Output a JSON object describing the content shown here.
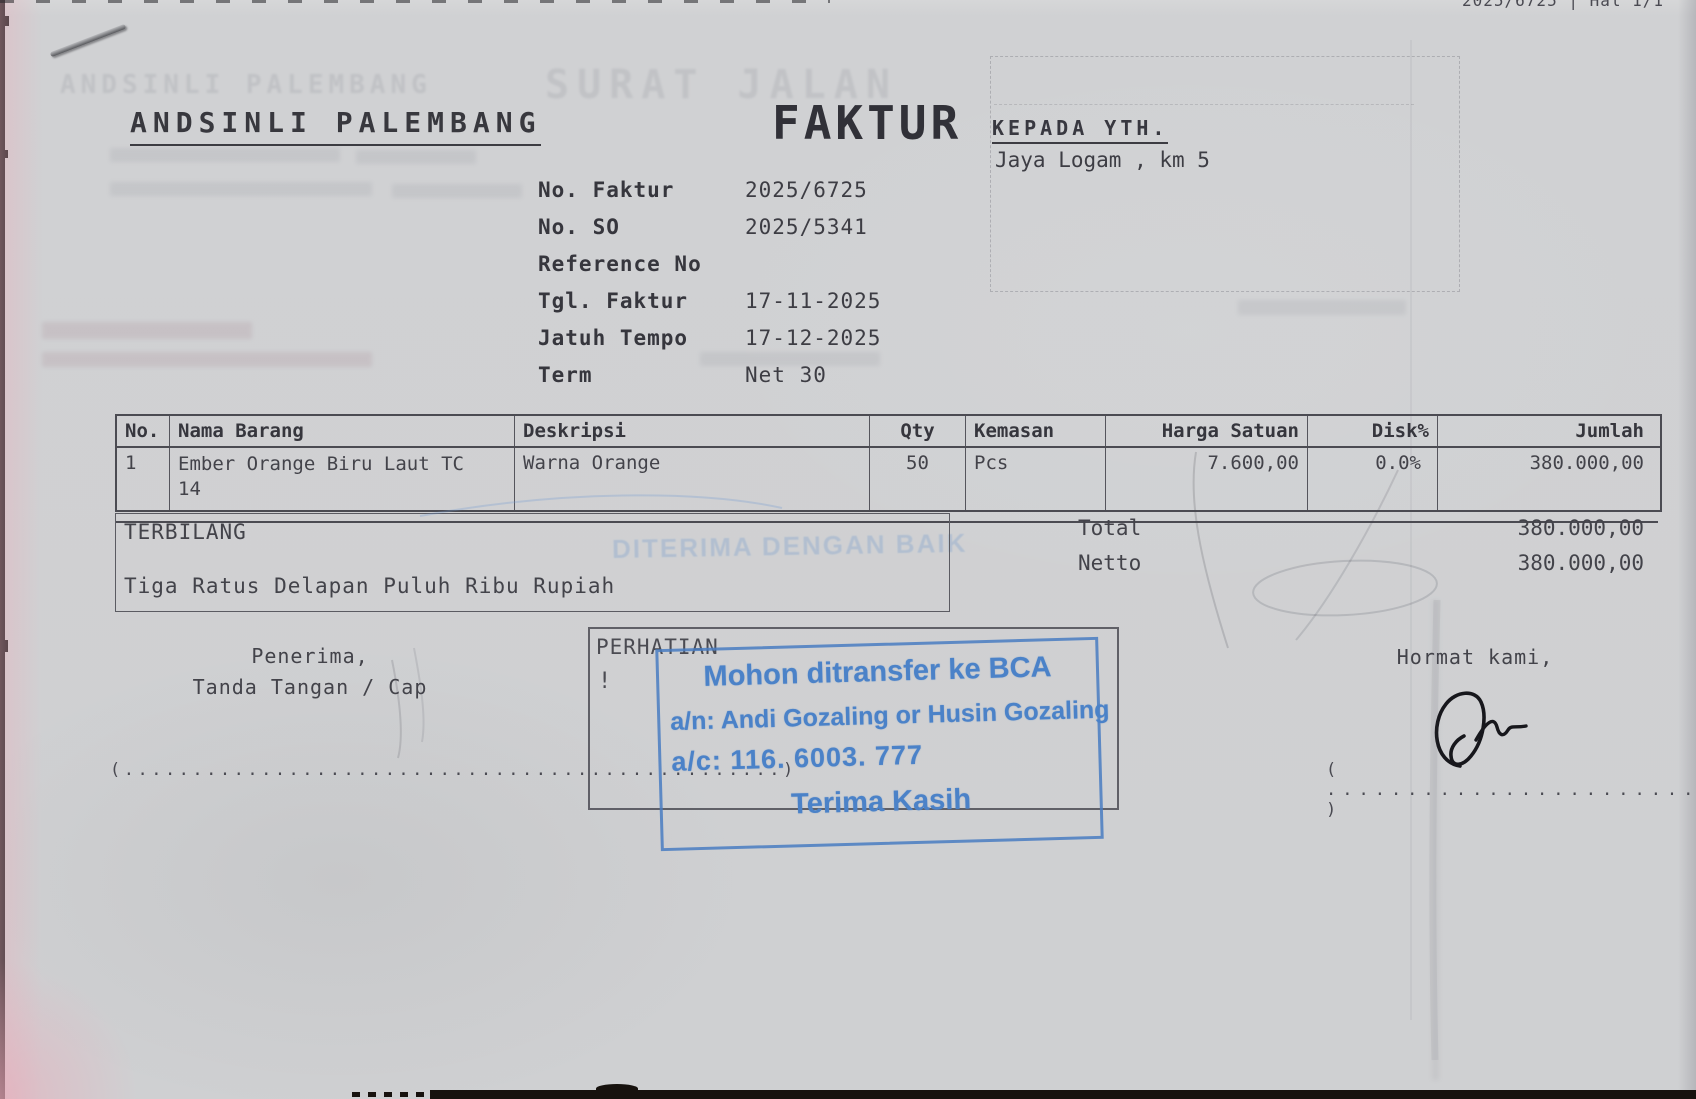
{
  "page": {
    "top_note": "2025/6725 | Hal 1/1",
    "company": "ANDSINLI PALEMBANG",
    "doc_title": "FAKTUR",
    "recipient_label": "KEPADA YTH.",
    "recipient_name": "Jaya Logam , km 5"
  },
  "meta": {
    "fields": [
      {
        "label": "No. Faktur",
        "value": "2025/6725"
      },
      {
        "label": "No. SO",
        "value": "2025/5341"
      },
      {
        "label": "Reference No",
        "value": ""
      },
      {
        "label": "Tgl. Faktur",
        "value": "17-11-2025"
      },
      {
        "label": "Jatuh Tempo",
        "value": "17-12-2025"
      },
      {
        "label": "Term",
        "value": "Net 30"
      }
    ]
  },
  "items_table": {
    "columns": [
      "No.",
      "Nama Barang",
      "Deskripsi",
      "Qty",
      "Kemasan",
      "Harga Satuan",
      "Disk%",
      "Jumlah"
    ],
    "rows": [
      {
        "no": "1",
        "nama": "Ember Orange Biru Laut  TC\n14",
        "deskripsi": "Warna Orange",
        "qty": "50",
        "kemasan": "Pcs",
        "harga_satuan": "7.600,00",
        "disk": "0.0%",
        "jumlah": "380.000,00"
      }
    ]
  },
  "terbilang": {
    "label": "TERBILANG",
    "text": "Tiga Ratus Delapan Puluh Ribu Rupiah"
  },
  "totals": {
    "total_label": "Total",
    "total_value": "380.000,00",
    "netto_label": "Netto",
    "netto_value": "380.000,00"
  },
  "attention": {
    "label": "PERHATIAN",
    "mark": "!"
  },
  "stamp": {
    "line1": "Mohon ditransfer ke BCA",
    "line2": "a/n: Andi Gozaling or Husin Gozaling",
    "line3": "a/c: 116. 6003. 777",
    "line4": "Terima Kasih",
    "ink_color": "#4b82c8"
  },
  "signatures": {
    "left_line1": "Penerima,",
    "left_line2": "Tanda Tangan / Cap",
    "left_dots": "(................................................)",
    "right_label": "Hormat kami,",
    "right_dots": "( ........................... )"
  },
  "ghost": {
    "company": "ANDSINLI PALEMBANG",
    "title": "SURAT JALAN",
    "stamp_text": "DITERIMA DENGAN BAIK"
  }
}
